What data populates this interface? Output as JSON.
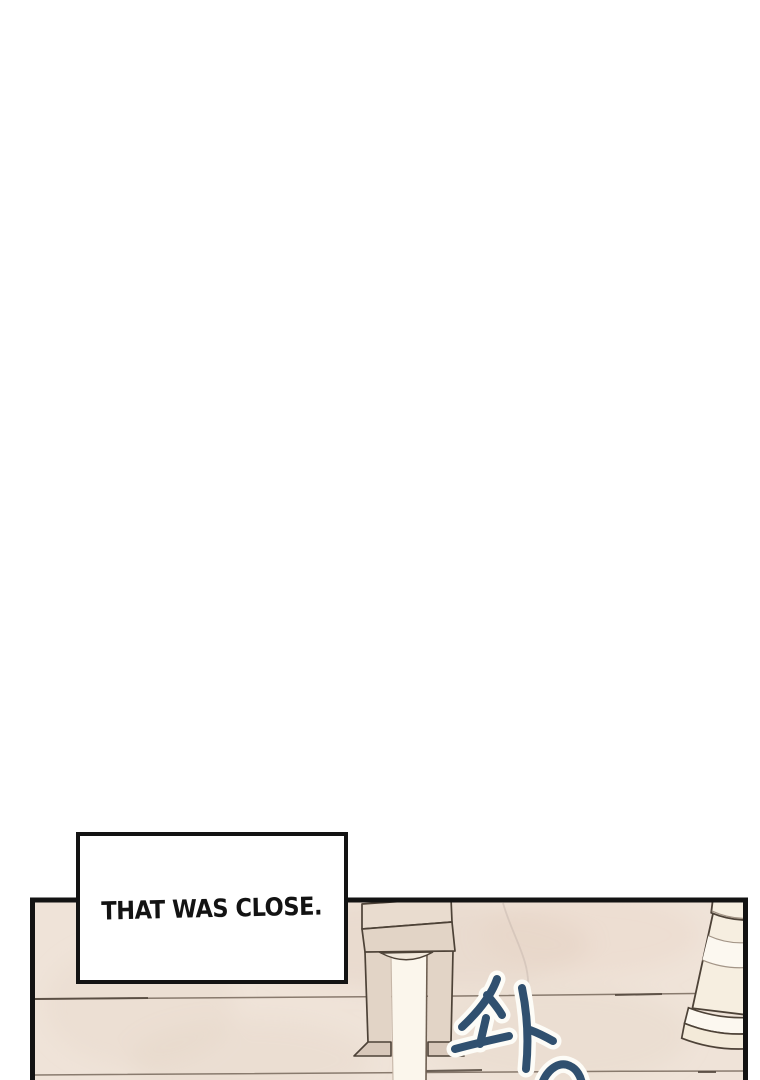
{
  "caption": {
    "text": "THAT WAS CLOSE."
  },
  "sfx": {
    "text": "솨"
  },
  "colors": {
    "page_bg": "#ffffff",
    "ink": "#131313",
    "caption_bg": "#ffffff",
    "panel_bg": "#efe3d8",
    "tile_line": "#6f6054",
    "outline_brown": "#4d4237",
    "fixture": "#e2d4c6",
    "fixture_top": "#e9dccf",
    "fixture_dark": "#d8c8ba",
    "cream": "#fbf6ec",
    "cup_cream": "#f6eee0",
    "cup_white": "#fcf8f0",
    "sfx_blue": "#30506f",
    "sfx_outline": "#fdfcf7"
  }
}
